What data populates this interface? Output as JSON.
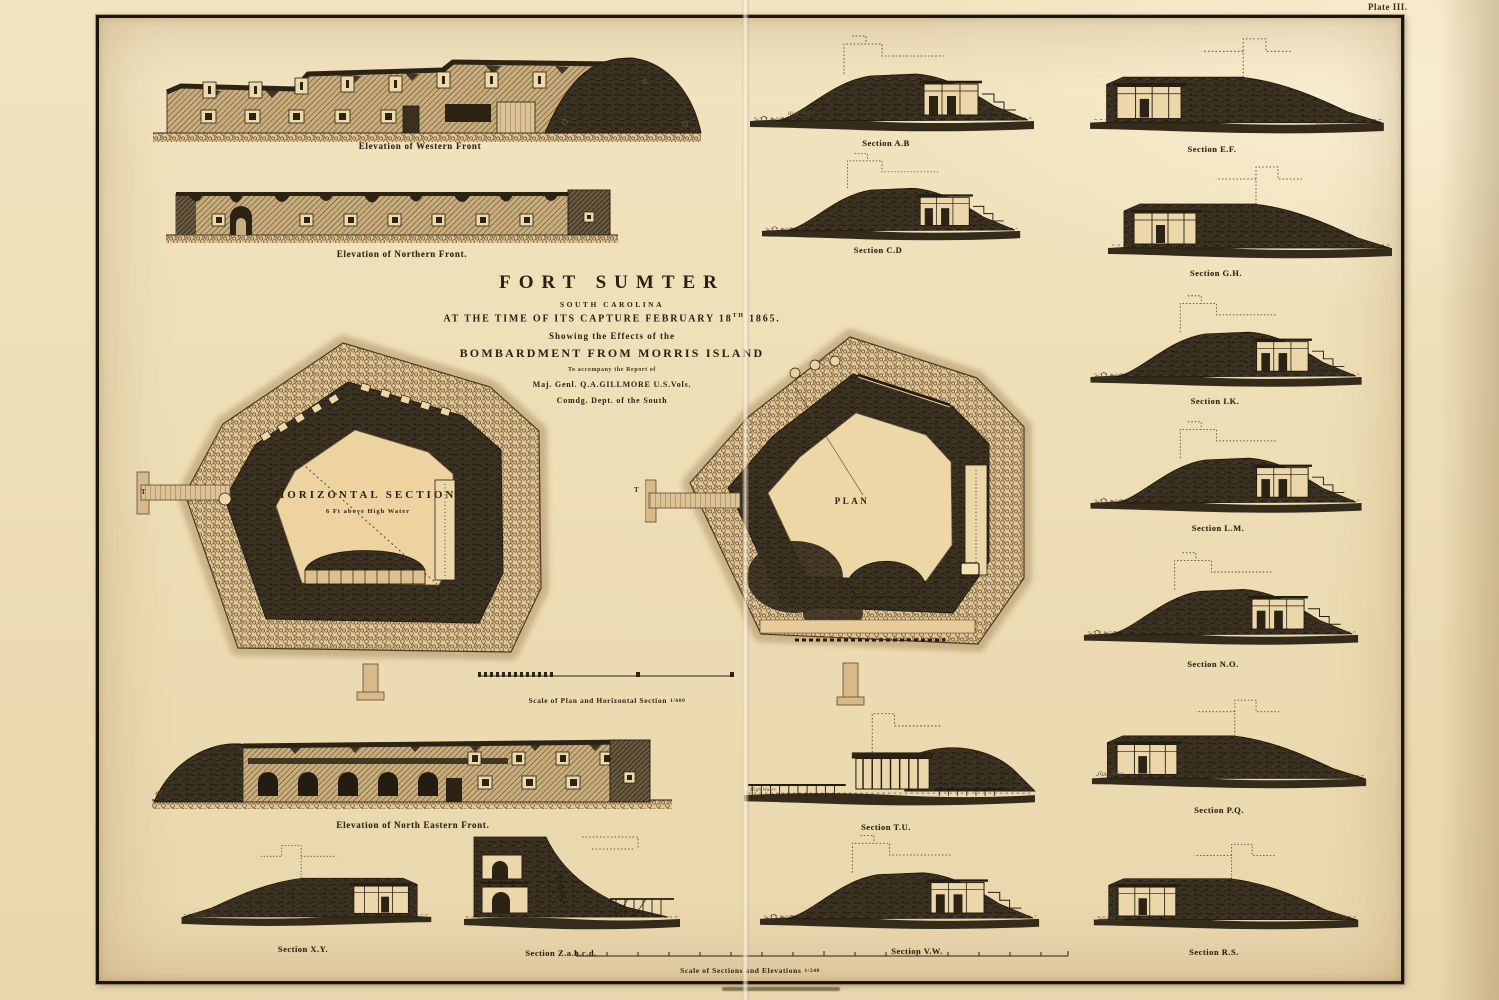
{
  "plate_label": "Plate III.",
  "title_block": {
    "title": "FORT SUMTER",
    "subtitle": "SOUTH CAROLINA",
    "capture_line_pre": "AT THE TIME OF ITS CAPTURE FEBRUARY 18",
    "capture_line_sup": "TH",
    "capture_line_post": " 1865.",
    "showing_line": "Showing the Effects of the",
    "bombardment_line": "BOMBARDMENT FROM MORRIS ISLAND",
    "accompany_line": "To accompany the Report of",
    "general_line": "Maj. Genl. Q.A.GILLMORE U.S.Vols.",
    "dept_line": "Comdg. Dept. of the South"
  },
  "plans": [
    {
      "label": "HORIZONTAL SECTION",
      "sublabel": "6 Ft above High Water",
      "wharf_letter": "T"
    },
    {
      "label": "PLAN",
      "wharf_letter": "T"
    }
  ],
  "elevations": [
    {
      "caption": "Elevation of Western Front"
    },
    {
      "caption": "Elevation of Northern Front."
    },
    {
      "caption": "Elevation of North Eastern Front."
    }
  ],
  "sections": [
    {
      "caption": "Section A.B"
    },
    {
      "caption": "Section C.D"
    },
    {
      "caption": "Section E.F."
    },
    {
      "caption": "Section G.H."
    },
    {
      "caption": "Section I.K."
    },
    {
      "caption": "Section L.M."
    },
    {
      "caption": "Section N.O."
    },
    {
      "caption": "Section P.Q."
    },
    {
      "caption": "Section R.S."
    },
    {
      "caption": "Section T.U."
    },
    {
      "caption": "Section V.W."
    },
    {
      "caption": "Section X.Y."
    },
    {
      "caption": "Section Z.a.b.c.d."
    }
  ],
  "scales": [
    {
      "caption": "Scale of Plan and Horizontal Section",
      "ratio": "1/600"
    },
    {
      "caption": "Scale of Sections and Elevations",
      "ratio": "1/240"
    }
  ],
  "annotations": {
    "high_water": "High Water"
  },
  "ink_color": "#2c2315",
  "paper_color": "#eed3a5"
}
